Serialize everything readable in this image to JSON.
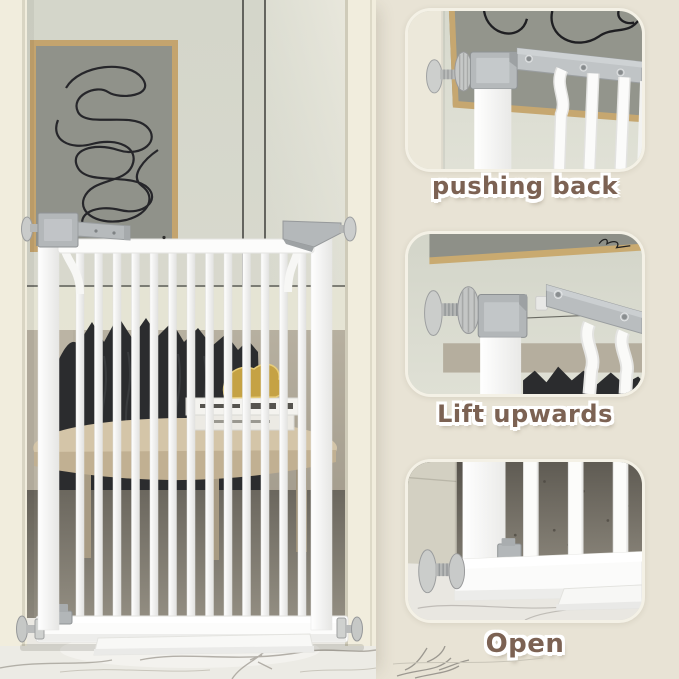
{
  "image": {
    "kind": "product-photo-collage",
    "subject": "white metal pressure-mounted baby safety gate in a living room with three close-up instruction panels"
  },
  "panels": [
    {
      "id": "pushing-back",
      "label": "pushing back"
    },
    {
      "id": "lift-upwards",
      "label": "Lift upwards"
    },
    {
      "id": "open",
      "label": "Open"
    }
  ],
  "colors": {
    "background_beige": "#e8e3d5",
    "label_brown": "#7c6253",
    "label_outline": "#ffffff",
    "gate_white": "#fbfbfa",
    "metal_gray": "#b4b8ba",
    "frame_tan": "#c6a770",
    "wall_gray_green": "#d6d8cc",
    "blanket_dark": "#2b2c2e",
    "table_wood": "#d0c1a4",
    "duck_gold": "#c5a244",
    "marble_white": "#ebe9e3"
  }
}
